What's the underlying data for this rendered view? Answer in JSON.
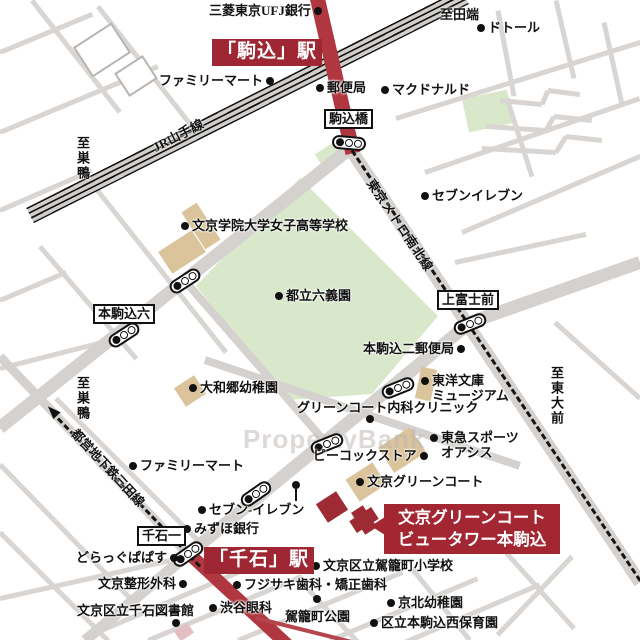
{
  "stations": {
    "komagome": "「駒込」駅",
    "sengoku": "「千石」駅"
  },
  "property_callout": {
    "line1": "文京グリーンコート",
    "line2": "ビュータワー本駒込"
  },
  "rail_lines": {
    "jr": "JR山手線",
    "namboku": "東京メトロ南北線",
    "mita": "都営地下鉄三田線"
  },
  "intersections": {
    "komagomebashi": "駒込橋",
    "honkomagome6": "本駒込六",
    "kamifujimae": "上富士前",
    "sengoku1": "千石一"
  },
  "directions": {
    "tabata": "至田端",
    "sugamo_top": "至巣鴨",
    "sugamo_left": "至巣鴨",
    "todaimae": "至東大前"
  },
  "watermark": "PropertyBank",
  "colors": {
    "road": "#d4d1ce",
    "park": "#d9e8cb",
    "building": "#dbc49c",
    "accent_red": "#9e2733",
    "road_red": "#b0373f"
  },
  "pois": [
    {
      "label": "三菱東京UFJ銀行"
    },
    {
      "label": "ドトール"
    },
    {
      "label": "ファミリーマート"
    },
    {
      "label": "郵便局"
    },
    {
      "label": "マクドナルド"
    },
    {
      "label": "セブンイレブン"
    },
    {
      "label": "文京学院大学女子高等学校"
    },
    {
      "label": "都立六義園"
    },
    {
      "label": "本駒込二郵便局"
    },
    {
      "label": "東洋文庫\nミュージアム"
    },
    {
      "label": "大和郷幼稚園"
    },
    {
      "label": "グリーンコート内科クリニック"
    },
    {
      "label": "東急スポーツ\nオアシス"
    },
    {
      "label": "ファミリーマート"
    },
    {
      "label": "ピーコックストア"
    },
    {
      "label": "文京グリーンコート"
    },
    {
      "label": "セブン-イレブン"
    },
    {
      "label": "みずほ銀行"
    },
    {
      "label": "どらっぐぱぱす"
    },
    {
      "label": "文京整形外科"
    },
    {
      "label": "フジサキ歯科・矯正歯科"
    },
    {
      "label": "文京区立駕籠町小学校"
    },
    {
      "label": "文京区立千石図書館"
    },
    {
      "label": "渋谷眼科"
    },
    {
      "label": "駕籠町公園"
    },
    {
      "label": "京北幼稚園"
    },
    {
      "label": "区立本駒込西保育園"
    }
  ]
}
